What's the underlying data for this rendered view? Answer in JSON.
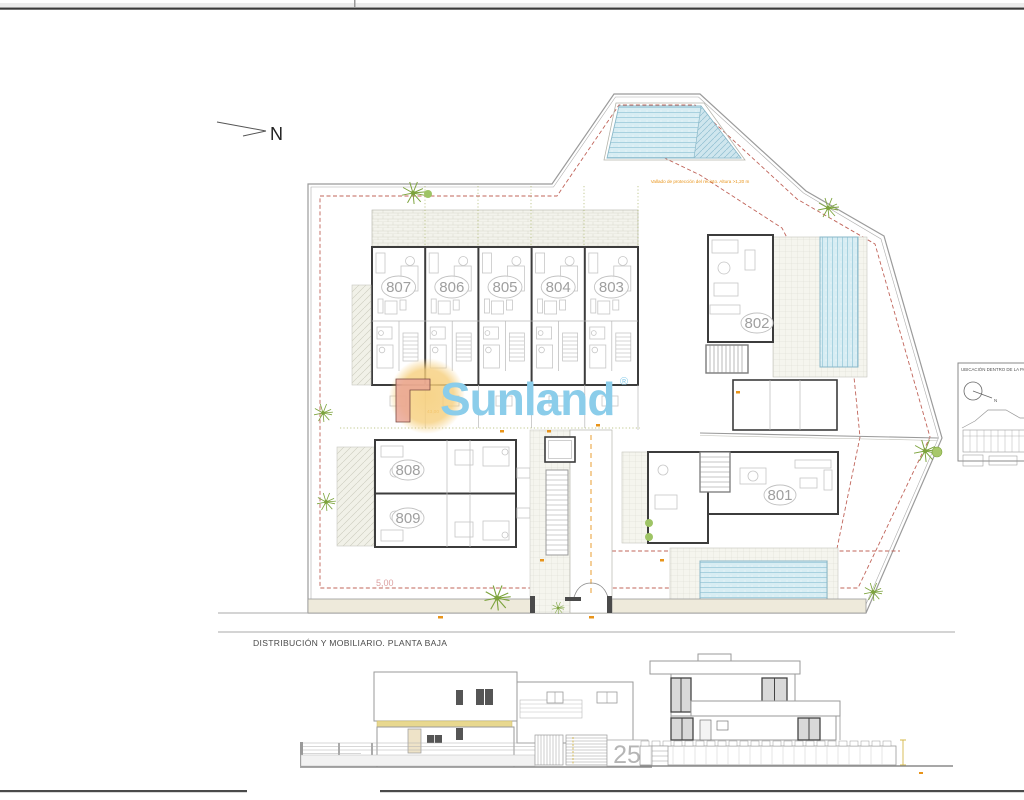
{
  "sheet": {
    "title": "DISTRIBUCIÓN Y MOBILIARIO. PLANTA BAJA",
    "north_label": "N"
  },
  "watermark": {
    "brand": "Sunland",
    "registered_mark": "®"
  },
  "site_plan": {
    "fence_note": "Vallado de protección del recinto. Altura >1,20 m",
    "dimension_left": "5,00",
    "dimension_center": "43,00",
    "unit_labels": [
      "807",
      "806",
      "805",
      "804",
      "803",
      "802",
      "801",
      "808",
      "809"
    ]
  },
  "location_inset": {
    "title": "UBICACIÓN DENTRO DE LA PARC",
    "north_label": "N"
  },
  "elevations": {
    "house_number": "25"
  },
  "colors": {
    "watermark_blue": "#8bcdea",
    "sun_yellow": "#f6cf7d",
    "pool_blue": "#d8edf3",
    "annotation_orange": "#e8941a",
    "setback_red": "#c0645a",
    "plant_green": "#7ca33c",
    "facade_band_yellow": "#e8d88f"
  }
}
